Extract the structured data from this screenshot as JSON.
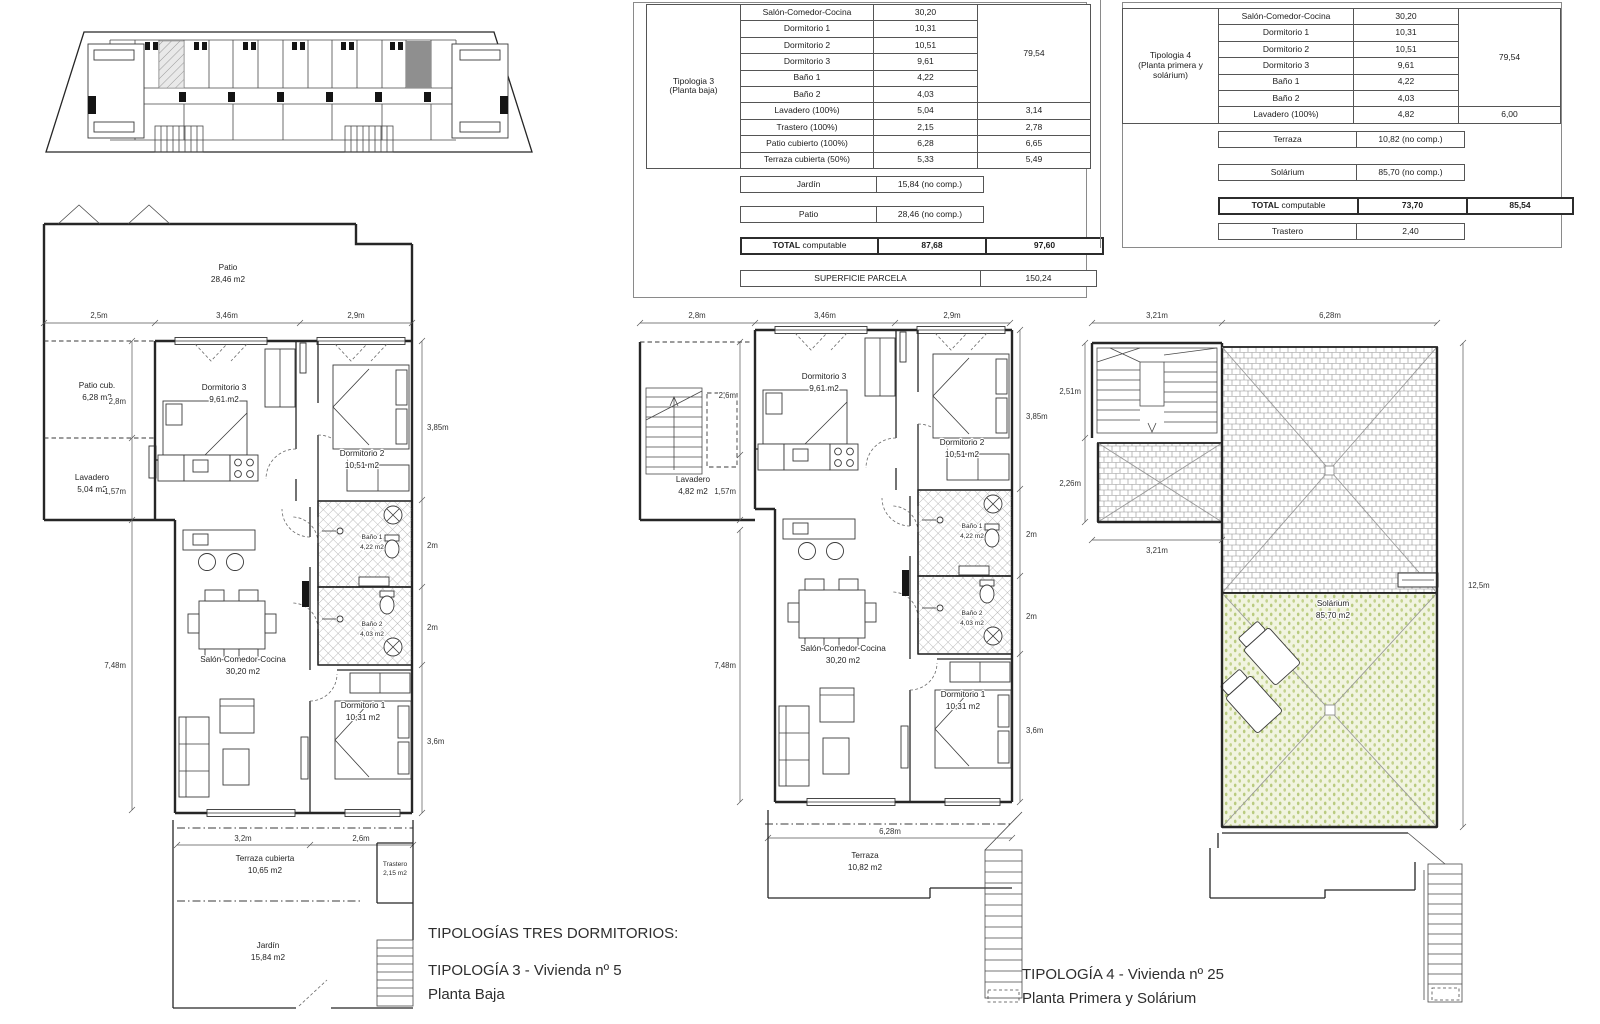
{
  "colors": {
    "line": "#262626",
    "dim": "#555555",
    "table_border": "#555555",
    "text": "#2e2e2e",
    "hatch_gray": "#a8a8a8",
    "roof_gray": "#909090",
    "solarium_fill": "#f1f4e0",
    "solarium_dot": "#b9cb7f",
    "site_highlight_dark": "#8f8f8f",
    "site_highlight_light": "#e3e3e3"
  },
  "titles": {
    "group": "TIPOLOGÍAS TRES DORMITORIOS:",
    "t3": "TIPOLOGÍA 3 - Vivienda nº 5",
    "t3_sub": "Planta Baja",
    "t4": "TIPOLOGÍA 4 - Vivienda nº 25",
    "t4_sub": "Planta Primera y Solárium"
  },
  "table3": {
    "label1": "Tipologia 3",
    "label2": "(Planta baja)",
    "rooms": [
      {
        "name": "Salón-Comedor-Cocina",
        "v": "30,20"
      },
      {
        "name": "Dormitorio 1",
        "v": "10,31"
      },
      {
        "name": "Dormitorio 2",
        "v": "10,51"
      },
      {
        "name": "Dormitorio 3",
        "v": "9,61"
      },
      {
        "name": "Baño 1",
        "v": "4,22"
      },
      {
        "name": "Baño 2",
        "v": "4,03"
      }
    ],
    "merged": "79,54",
    "extra": [
      {
        "name": "Lavadero (100%)",
        "v": "5,04",
        "v2": "3,14"
      },
      {
        "name": "Trastero (100%)",
        "v": "2,15",
        "v2": "2,78"
      },
      {
        "name": "Patio cubierto (100%)",
        "v": "6,28",
        "v2": "6,65"
      },
      {
        "name": "Terraza cubierta (50%)",
        "v": "5,33",
        "v2": "5,49"
      }
    ],
    "jardin": {
      "name": "Jardín",
      "v": "15,84 (no comp.)"
    },
    "patio": {
      "name": "Patio",
      "v": "28,46 (no comp.)"
    },
    "total": {
      "bold": "TOTAL",
      "rest": " computable",
      "v": "87,68",
      "v2": "97,60"
    },
    "parcela": {
      "name": "SUPERFICIE PARCELA",
      "v": "150,24"
    }
  },
  "table4": {
    "label1": "Tipologia 4",
    "label2": "(Planta primera y",
    "label3": "solárium)",
    "rooms": [
      {
        "name": "Salón-Comedor-Cocina",
        "v": "30,20"
      },
      {
        "name": "Dormitorio 1",
        "v": "10,31"
      },
      {
        "name": "Dormitorio 2",
        "v": "10,51"
      },
      {
        "name": "Dormitorio 3",
        "v": "9,61"
      },
      {
        "name": "Baño 1",
        "v": "4,22"
      },
      {
        "name": "Baño 2",
        "v": "4,03"
      }
    ],
    "merged": "79,54",
    "extra": [
      {
        "name": "Lavadero (100%)",
        "v": "4,82",
        "v2": "6,00"
      }
    ],
    "terraza": {
      "name": "Terraza",
      "v": "10,82 (no comp.)"
    },
    "solarium": {
      "name": "Solárium",
      "v": "85,70 (no comp.)"
    },
    "total": {
      "bold": "TOTAL",
      "rest": " computable",
      "v": "73,70",
      "v2": "85,54"
    },
    "trastero": {
      "name": "Trastero",
      "v": "2,40"
    }
  },
  "plan3": {
    "patio": {
      "name": "Patio",
      "area": "28,46 m2"
    },
    "patio_cub": {
      "name": "Patio cub.",
      "area": "6,28 m2"
    },
    "lavadero": {
      "name": "Lavadero",
      "area": "5,04 m2"
    },
    "dorm3": {
      "name": "Dormitorio 3",
      "area": "9,61 m2"
    },
    "dorm2": {
      "name": "Dormitorio 2",
      "area": "10,51 m2"
    },
    "salon": {
      "name": "Salón-Comedor-Cocina",
      "area": "30,20 m2"
    },
    "bano1": {
      "name": "Baño 1",
      "area": "4,22 m2"
    },
    "bano2": {
      "name": "Baño 2",
      "area": "4,03 m2"
    },
    "dorm1": {
      "name": "Dormitorio 1",
      "area": "10,31 m2"
    },
    "terraza": {
      "name": "Terraza cubierta",
      "area": "10,65 m2"
    },
    "trastero": {
      "name": "Trastero",
      "area": "2,15 m2"
    },
    "jardin": {
      "name": "Jardín",
      "area": "15,84 m2"
    },
    "dims": {
      "top1": "2,5m",
      "top2": "3,46m",
      "top3": "2,9m",
      "left1": "2,8m",
      "left2": "1,57m",
      "left3": "7,48m",
      "right1": "3,85m",
      "right2": "2m",
      "right3": "2m",
      "right4": "3,6m",
      "bot1": "3,2m",
      "bot2": "2,6m"
    }
  },
  "plan4a": {
    "lavadero": {
      "name": "Lavadero",
      "area": "4,82 m2"
    },
    "dorm3": {
      "name": "Dormitorio 3",
      "area": "9,61 m2"
    },
    "dorm2": {
      "name": "Dormitorio 2",
      "area": "10,51 m2"
    },
    "salon": {
      "name": "Salón-Comedor-Cocina",
      "area": "30,20 m2"
    },
    "bano1": {
      "name": "Baño 1",
      "area": "4,22 m2"
    },
    "bano2": {
      "name": "Baño 2",
      "area": "4,03 m2"
    },
    "dorm1": {
      "name": "Dormitorio 1",
      "area": "10,31 m2"
    },
    "terraza": {
      "name": "Terraza",
      "area": "10,82 m2"
    },
    "dims": {
      "top1": "2,8m",
      "top2": "3,46m",
      "top3": "2,9m",
      "left1": "2,6m",
      "left2": "1,57m",
      "left3": "7,48m",
      "right1": "3,85m",
      "right2": "2m",
      "right3": "2m",
      "right4": "3,6m",
      "bot1": "6,28m"
    }
  },
  "plan4b": {
    "solarium": {
      "name": "Solárium",
      "area": "85,70 m2"
    },
    "dims": {
      "top1": "3,21m",
      "top2": "6,28m",
      "left1": "2,51m",
      "left2": "2,26m",
      "left3": "3,21m",
      "right1": "12,5m"
    }
  }
}
